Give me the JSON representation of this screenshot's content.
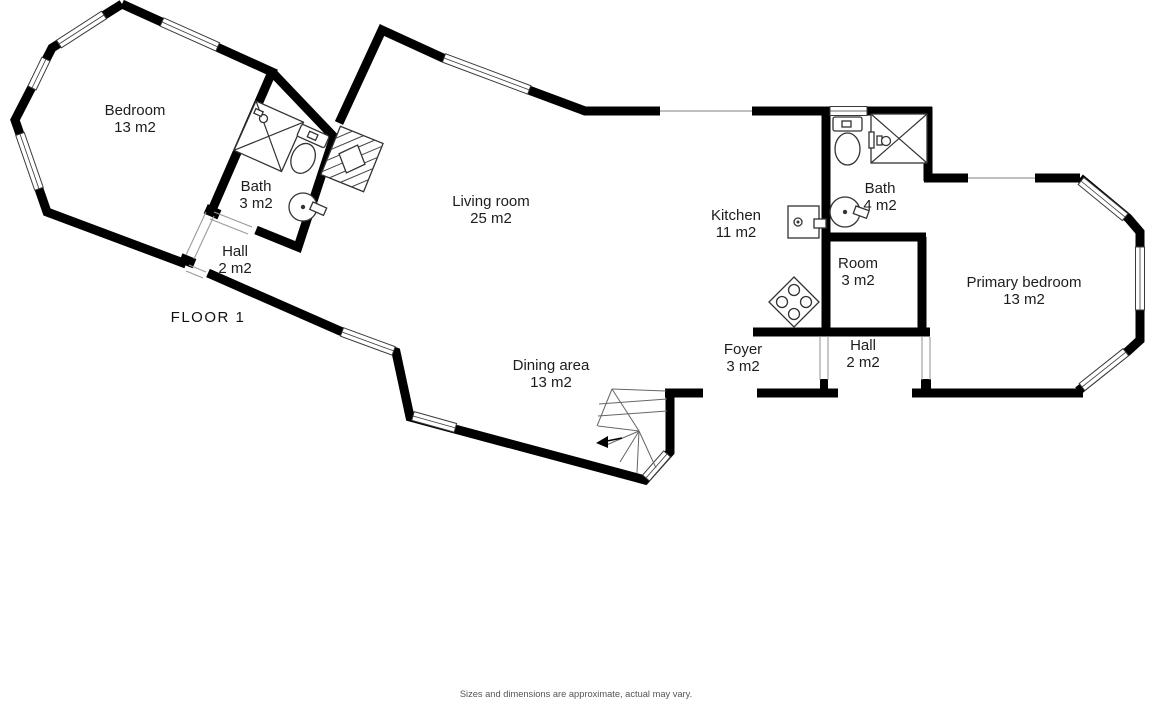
{
  "floor_plan": {
    "floor_label": "FLOOR 1",
    "disclaimer": "Sizes and dimensions are approximate, actual may vary.",
    "rooms": [
      {
        "id": "bedroom",
        "name": "Bedroom",
        "area": "13 m2"
      },
      {
        "id": "bath-left",
        "name": "Bath",
        "area": "3 m2"
      },
      {
        "id": "hall-left",
        "name": "Hall",
        "area": "2 m2"
      },
      {
        "id": "living-room",
        "name": "Living room",
        "area": "25 m2"
      },
      {
        "id": "kitchen",
        "name": "Kitchen",
        "area": "11 m2"
      },
      {
        "id": "bath-right",
        "name": "Bath",
        "area": "4 m2"
      },
      {
        "id": "room",
        "name": "Room",
        "area": "3 m2"
      },
      {
        "id": "primary-bedroom",
        "name": "Primary bedroom",
        "area": "13 m2"
      },
      {
        "id": "foyer",
        "name": "Foyer",
        "area": "3 m2"
      },
      {
        "id": "hall-right",
        "name": "Hall",
        "area": "2 m2"
      },
      {
        "id": "dining-area",
        "name": "Dining area",
        "area": "13 m2"
      }
    ],
    "fixtures": [
      "shower",
      "toilet",
      "sink",
      "stove",
      "kitchen-unit",
      "stairs",
      "chimney",
      "window"
    ],
    "colors": {
      "wall": "#000000",
      "background": "#ffffff",
      "label_text": "#1d1d1d",
      "disclaimer_text": "#555555",
      "fixture_line": "#333333"
    }
  }
}
